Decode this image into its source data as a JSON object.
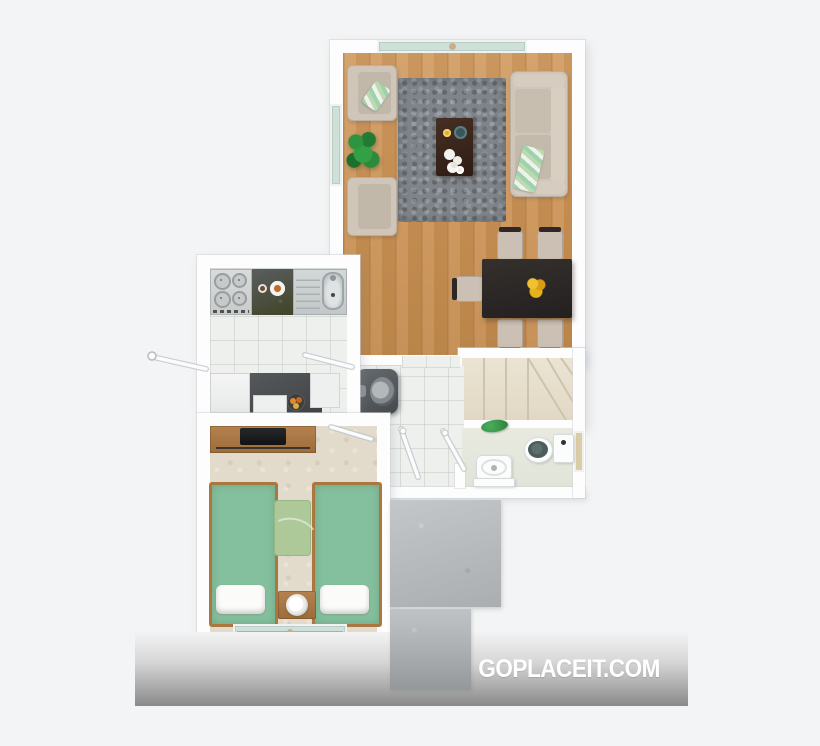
{
  "watermark": {
    "label": "GOPLACEIT.COM"
  },
  "branding_band": {
    "gradient_top": "#f3f3f3",
    "gradient_bottom": "#8a8a8a",
    "text_color": "#ffffff"
  },
  "floorplan": {
    "style": "top-down 3D render, unlabeled rooms",
    "rooms": [
      {
        "name": "living-dining-room",
        "floor": "wood",
        "furniture": [
          "armchair",
          "armchair",
          "potted-plant",
          "gray-shag-rug",
          "coffee-table-with-dishes",
          "sofa-with-striped-throw",
          "dining-table-with-flowers",
          "dining-chair-x5",
          "window-top",
          "window-left"
        ]
      },
      {
        "name": "kitchen",
        "floor": "white-tile",
        "furniture": [
          "gas-stove-4-burner",
          "granite-counter-with-plates",
          "stainless-sink",
          "refrigerator",
          "granite-counter-with-fruit-bowl",
          "drawer-unit",
          "cabinet",
          "entry-door-open"
        ]
      },
      {
        "name": "hallway",
        "floor": "white-tile",
        "furniture": [
          "wall-water-heater",
          "door-swing-bedroom",
          "door-swing-bathroom"
        ]
      },
      {
        "name": "staircase",
        "floor": "beige-carpet",
        "furniture": [
          "straight-treads",
          "winder-treads",
          "plant-on-shelf"
        ]
      },
      {
        "name": "bathroom",
        "floor": "pale-tile",
        "furniture": [
          "pedestal-sink",
          "toilet",
          "washing-machine",
          "window-right"
        ]
      },
      {
        "name": "bedroom",
        "floor": "beige-carpet",
        "furniture": [
          "tv-dresser",
          "single-bed-green",
          "single-bed-green",
          "green-rug",
          "nightstand-with-lamp",
          "window-bottom",
          "door-swing"
        ]
      },
      {
        "name": "patio",
        "floor": "concrete",
        "furniture": [
          "concrete-tile-large",
          "concrete-tile-small"
        ]
      }
    ]
  },
  "theme": {
    "bg": "#f3f4f5",
    "wall": "#fdfdfe",
    "wood": "#cc9255",
    "rug": "#7e848a",
    "beige": "#cfc5b8",
    "glass": "#cfe0d9",
    "kitchenTile": "#eef0ee",
    "granite": "#515456",
    "steel": "#c9cecf",
    "carpet": "#e2dacb",
    "stairCarpet": "#e8e0cf",
    "bedGreen": "#85c09e",
    "rugGreen": "#adc999",
    "bathFloor": "#e5e7dd",
    "toiletSeat": "#4b5c5a",
    "heater": "#54585c",
    "tableDark": "#2d2826",
    "coffeeTable": "#3a2820",
    "flower": "#e7b31c",
    "plantGreen": "#2f8f3f",
    "concrete": "#b7bbbd",
    "watermark": "#ffffff"
  }
}
